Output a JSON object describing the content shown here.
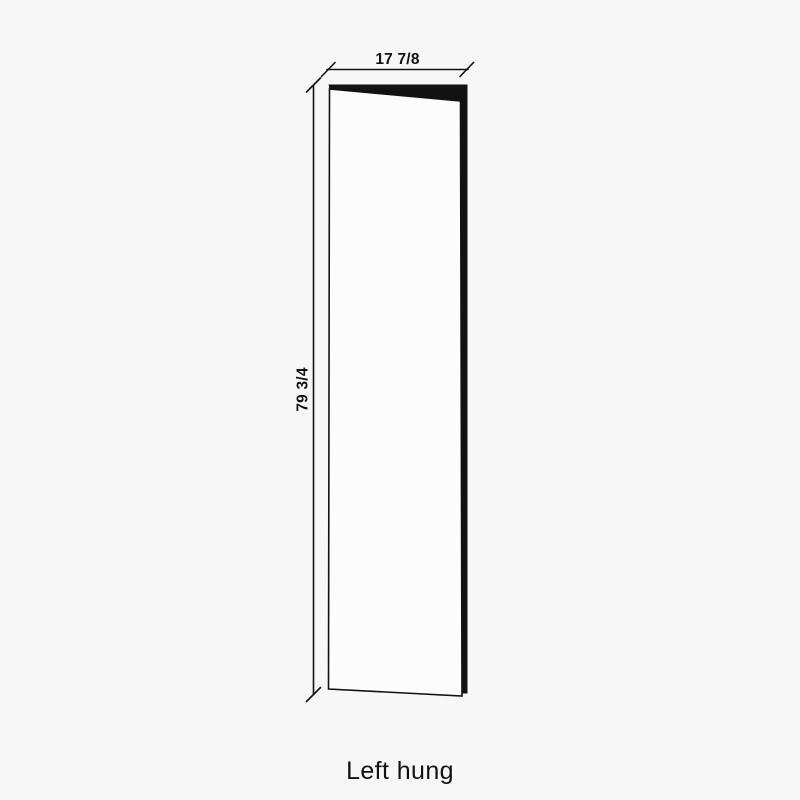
{
  "diagram": {
    "width_label": "17 7/8",
    "height_label": "79 3/4",
    "caption": "Left hung"
  },
  "colors": {
    "background": "#f7f7f7",
    "line": "#121212",
    "panel_fill": "#fcfcfc",
    "text": "#121212"
  }
}
